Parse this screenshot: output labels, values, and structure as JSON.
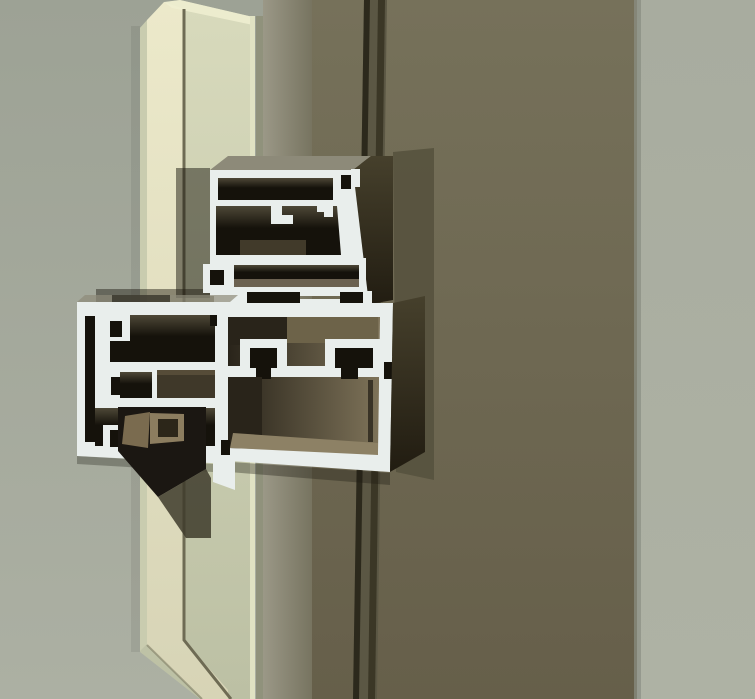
{
  "palette": {
    "bg_left_top": "#9da295",
    "bg_left_bottom": "#acb0a3",
    "bg_right_top": "#a8ac9f",
    "bg_right_bottom": "#aeb2a4",
    "mullion_face_top": "#76715a",
    "mullion_face_bottom": "#665f4a",
    "mullion_side_light": "#9b9887",
    "mullion_side_dark": "#777460",
    "face_edge_soft": "#8b9084",
    "groove_dark": "#2c291c",
    "groove_dark2": "#3b3726",
    "groove_mid": "#5b5744",
    "panel_left_facet": "#c9ccaf",
    "panel_bright_top": "#ece9ca",
    "panel_bright_bottom": "#d7d4b6",
    "panel_wide_top": "#d8dabc",
    "panel_wide_bottom": "#bcc0a4",
    "panel_bevel_highlight": "#f0eed1",
    "panel_seam": "#6e6b54",
    "panel_edge_light": "#e0e2c3",
    "panel_edge_dark": "#90927c",
    "cut_face": "#e9eeec",
    "chamber_top": "#4e4837",
    "chamber_dark": "#15120b",
    "chamber_brown": "#3f3829",
    "chamber_brown_light": "#564c38",
    "side_face_light": "#46402c",
    "side_face_dark": "#211c11",
    "face_shadow_band": "#56523e",
    "top_face_gray": "#8d8a79",
    "interior_wall_olive": "#6d6349",
    "interior_dark": "#29241a",
    "interior_floor": "#7e7359",
    "interior_floor_light": "#8d8165",
    "inner_brown": "#6b6150",
    "reflection_brown": "#463f2e",
    "nose_dark": "#1b1712",
    "nose_face_light": "#7a6b4f",
    "nose_face_mid": "#8c7d5f",
    "nose_inset": "#2c2619",
    "nose_shadow": "#3e3b2b",
    "shadow_soft": "#1c1910"
  },
  "scene": {
    "label": "photo of aluminum curtain-wall profile cross-sections on a mullion with beveled glass panel",
    "parts": [
      "background-left-wall",
      "background-right-wall",
      "mullion-side-face",
      "mullion-front-face",
      "mullion-shadow-groove",
      "beveled-glass-panel",
      "transom-profile-cutaway",
      "vent-frame-profile-cutaway",
      "mullion-box-profile-cutaway",
      "glazing-gasket-nose"
    ]
  }
}
